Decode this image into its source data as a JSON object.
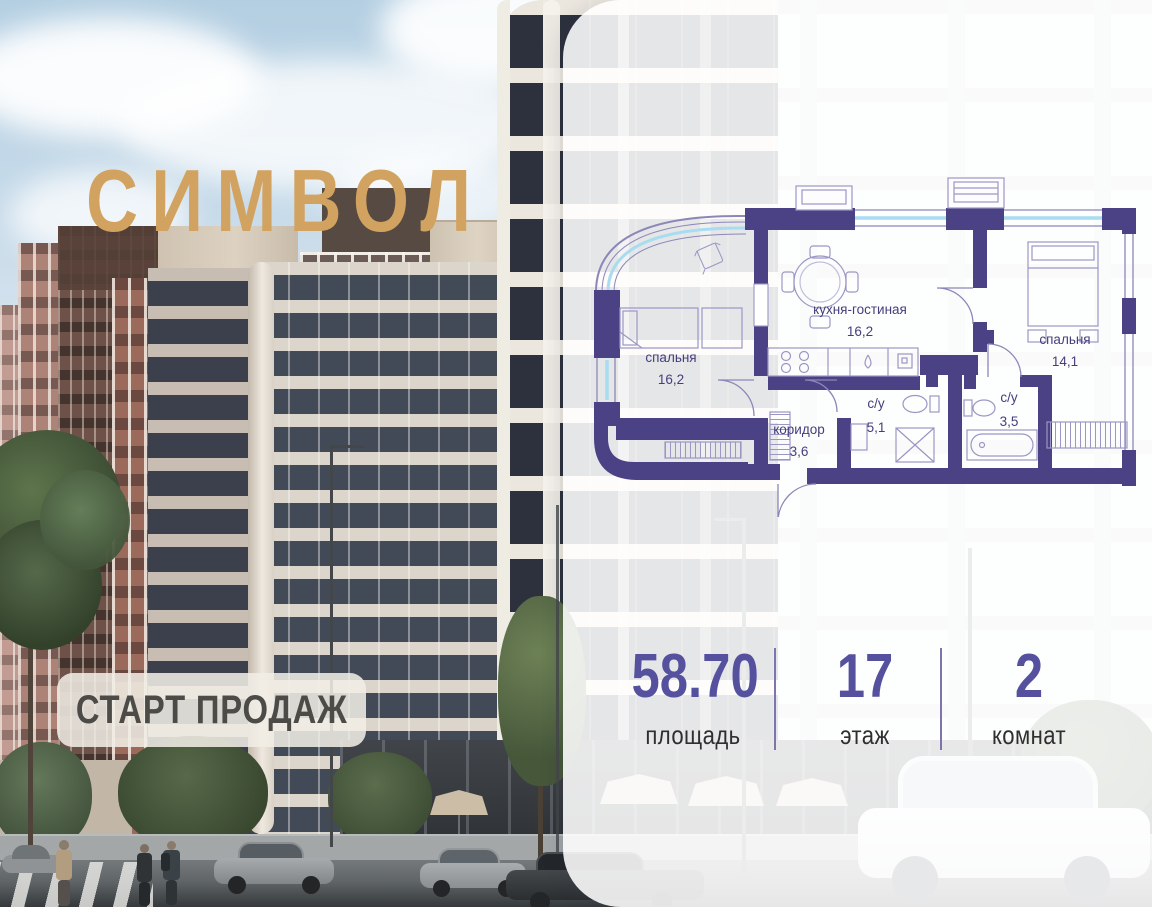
{
  "brand": {
    "logo_text": "СИМВОЛ",
    "badge_text": "СТАРТ ПРОДАЖ"
  },
  "floor_plan": {
    "rooms": [
      {
        "name": "спальня",
        "area": "16,2"
      },
      {
        "name": "кухня-гостиная",
        "area": "16,2"
      },
      {
        "name": "спальня",
        "area": "14,1"
      },
      {
        "name": "коридор",
        "area": "3,6"
      },
      {
        "name": "с/у",
        "area": "5,1"
      },
      {
        "name": "с/у",
        "area": "3,5"
      }
    ]
  },
  "stats": {
    "items": [
      {
        "value": "58.70",
        "label": "площадь"
      },
      {
        "value": "17",
        "label": "этаж"
      },
      {
        "value": "2",
        "label": "комнат"
      }
    ]
  },
  "colors": {
    "wall": "#4a4285",
    "accent_number": "#55519e",
    "logo_gold": "#d2a360",
    "glazing_blue": "#a8dcf0",
    "badge_bg": "#f1eee6"
  }
}
